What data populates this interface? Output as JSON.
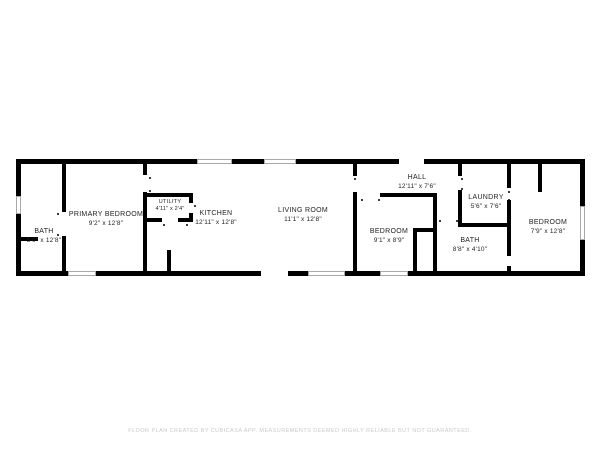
{
  "page": {
    "background": "#ffffff",
    "wall_color": "#000000"
  },
  "floor_plan": {
    "rooms": [
      {
        "id": "bath-left",
        "name": "BATH",
        "dims": "5'0\" x 12'8\""
      },
      {
        "id": "primary-bedroom",
        "name": "PRIMARY BEDROOM",
        "dims": "9'2\" x 12'8\""
      },
      {
        "id": "utility",
        "name": "UTILITY",
        "dims": "4'11\" x 2'4\""
      },
      {
        "id": "kitchen",
        "name": "KITCHEN",
        "dims": "12'11\" x 12'8\""
      },
      {
        "id": "living-room",
        "name": "LIVING ROOM",
        "dims": "11'1\" x 12'8\""
      },
      {
        "id": "hall",
        "name": "HALL",
        "dims": "12'11\" x 7'6\""
      },
      {
        "id": "bedroom-middle",
        "name": "BEDROOM",
        "dims": "9'1\" x 8'9\""
      },
      {
        "id": "laundry",
        "name": "LAUNDRY",
        "dims": "5'6\" x 7'6\""
      },
      {
        "id": "bath-right",
        "name": "BATH",
        "dims": "8'8\" x 4'10\""
      },
      {
        "id": "bedroom-right",
        "name": "BEDROOM",
        "dims": "7'9\" x 12'8\""
      }
    ]
  },
  "footer": {
    "text": "FLOOR PLAN CREATED BY CUBICASA APP. MEASUREMENTS DEEMED HIGHLY RELIABLE BUT NOT GUARANTEED."
  }
}
